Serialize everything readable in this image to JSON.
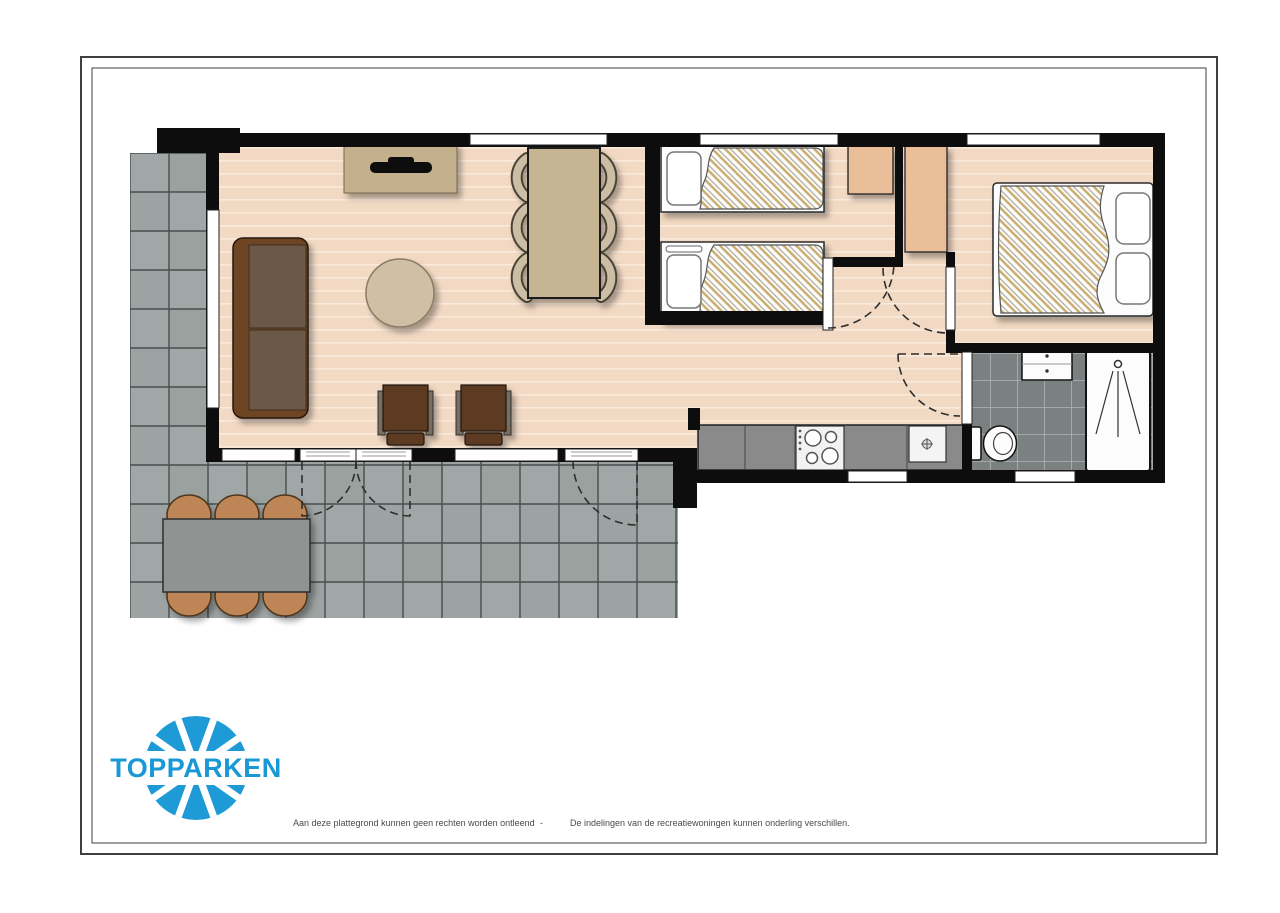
{
  "brand": {
    "logo_text": "TOPPARKEN"
  },
  "footer": {
    "disclaimer_left": "Aan deze plattegrond kunnen geen rechten worden ontleend",
    "separator": "-",
    "disclaimer_right": "De indelingen van de recreatiewoningen kunnen onderling verschillen."
  },
  "colors": {
    "wall": "#0d0d0d",
    "floor_wood": "#F2D9C3",
    "floor_wood_stripe": "#FAEADB",
    "terrace_tile": "#9FA6A5",
    "terrace_grout": "#3E4443",
    "bath_tile": "#7B8180",
    "bath_grout": "#AFB5B4",
    "window_white": "#FFFFFF",
    "sofa_frame": "#6E4423",
    "sofa_cushion": "#6C5947",
    "armchair_seat": "#5C3A22",
    "armchair_arm": "#776D60",
    "dining_table": "#C7B493",
    "dining_chair": "#CBBEA4",
    "tv_cabinet": "#C4B08D",
    "coffee_table": "#D0BFA5",
    "closet": "#E9BE98",
    "counter": "#8A8A8A",
    "fixture_white": "#FCFCFC",
    "outdoor_chair": "#BE8656",
    "outdoor_table": "#8F9392",
    "duvet_hatch": "#C9AC6E",
    "brand_blue": "#1898D5",
    "frame_line": "#3f3f3f",
    "disclaimer_text": "#4a4a4a"
  }
}
